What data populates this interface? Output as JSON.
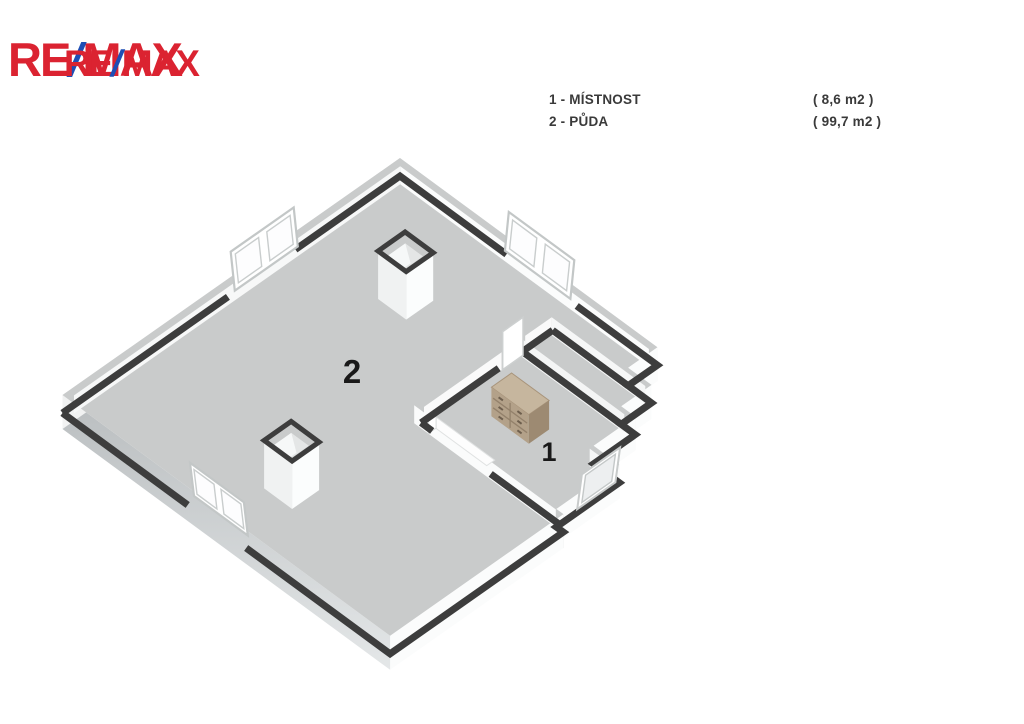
{
  "logo": {
    "copies": [
      {
        "re": "RE",
        "slash": "/",
        "max": "MAX"
      },
      {
        "re": "RE",
        "slash": "/",
        "max": "MAX"
      }
    ]
  },
  "legend": {
    "rows": [
      {
        "label": "1 - MÍSTNOST",
        "area": "( 8,6 m2 )"
      },
      {
        "label": "2 - PŮDA",
        "area": "( 99,7 m2 )"
      }
    ]
  },
  "plan": {
    "labels": [
      {
        "text": "2"
      },
      {
        "text": "1"
      }
    ]
  },
  "colors": {
    "remax_red": "#DB2331",
    "remax_blue": "#1F4EB5",
    "wall_top": "#3d3d3d",
    "floor": "#c9cbcb",
    "background": "#ffffff",
    "furniture_front": "#b3a189",
    "furniture_top": "#c6b69e",
    "furniture_side": "#9d8a72"
  }
}
